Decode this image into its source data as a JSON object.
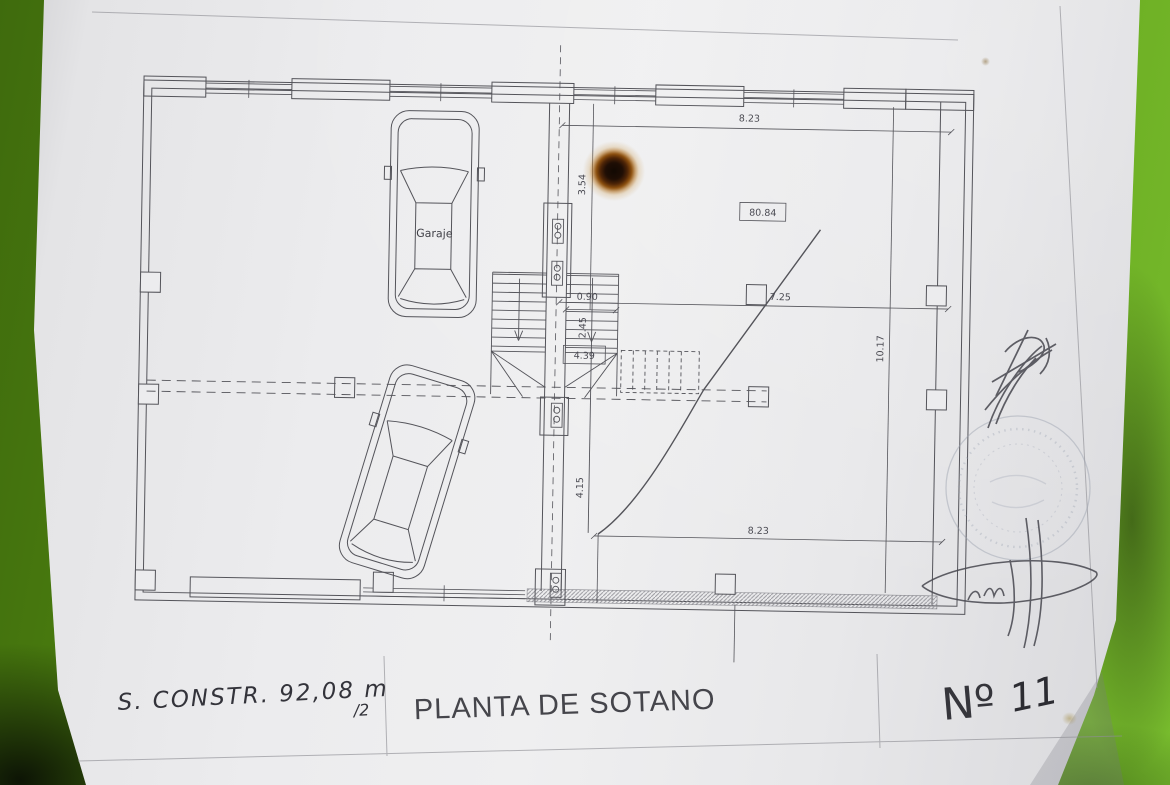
{
  "photo": {
    "background_green_dark": "#3f6b0d",
    "background_green_light": "#78bc2e",
    "paper_color": "#ececee",
    "line_color": "#54545a",
    "marks": [
      "burn-hole",
      "ink-stamp-circle",
      "pencil-signature-upper",
      "pencil-signature-lower"
    ]
  },
  "plan": {
    "room_label": "Garaje",
    "area_label": "80.84",
    "dims": {
      "top_width": "8.23",
      "upper_height": "3.54",
      "mid_width": "7.25",
      "right_height": "10.17",
      "stair_width": "0.90",
      "stair_run": "2.45",
      "landing": "4.39",
      "lower_height": "4.15",
      "bottom_width": "8.23"
    }
  },
  "titleblock": {
    "note_main": "S. CONSTR.  92,08 m",
    "note_frac": "/2",
    "title": "PLANTA DE SOTANO",
    "number_label": "Nº",
    "number_value": "11"
  }
}
